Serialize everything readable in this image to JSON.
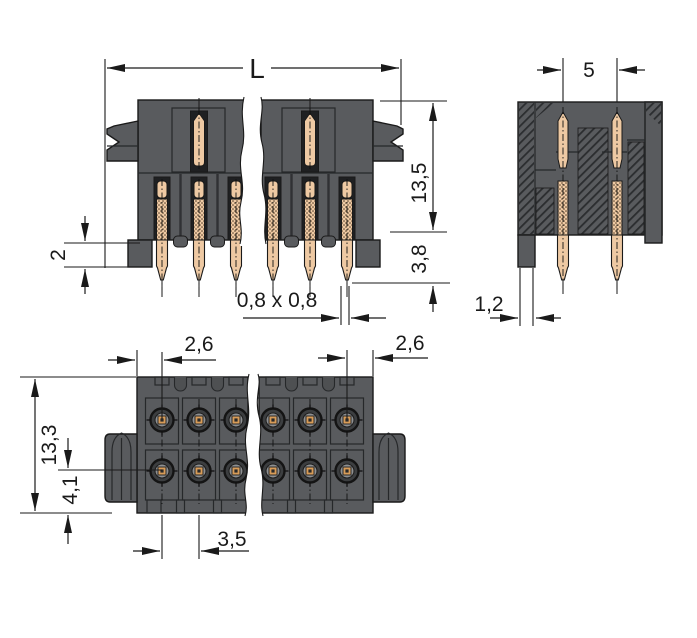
{
  "drawing": {
    "kind": "technical-dimension-drawing",
    "subject": "dual-row male header connector, three orthographic views"
  },
  "palette": {
    "line": "#1a1a1a",
    "body_gray": "#595b5e",
    "body_light": "#6b6d6f",
    "body_dark": "#46484a",
    "slot_black": "#1f2022",
    "pin_tan": "#eec9a3",
    "contact_orange": "#d89c58",
    "background": "#ffffff"
  },
  "dims": {
    "length": "L",
    "row_spacing": "5",
    "height": "13,5",
    "pin_protrusion": "3,8",
    "leg_width": "1,2",
    "step": "2",
    "pin_square": "0,8 x 0,8",
    "edge_pin_left": "2,6",
    "edge_pin_right": "2,6",
    "depth": "13,3",
    "row_offset": "4,1",
    "pitch": "3,5"
  }
}
